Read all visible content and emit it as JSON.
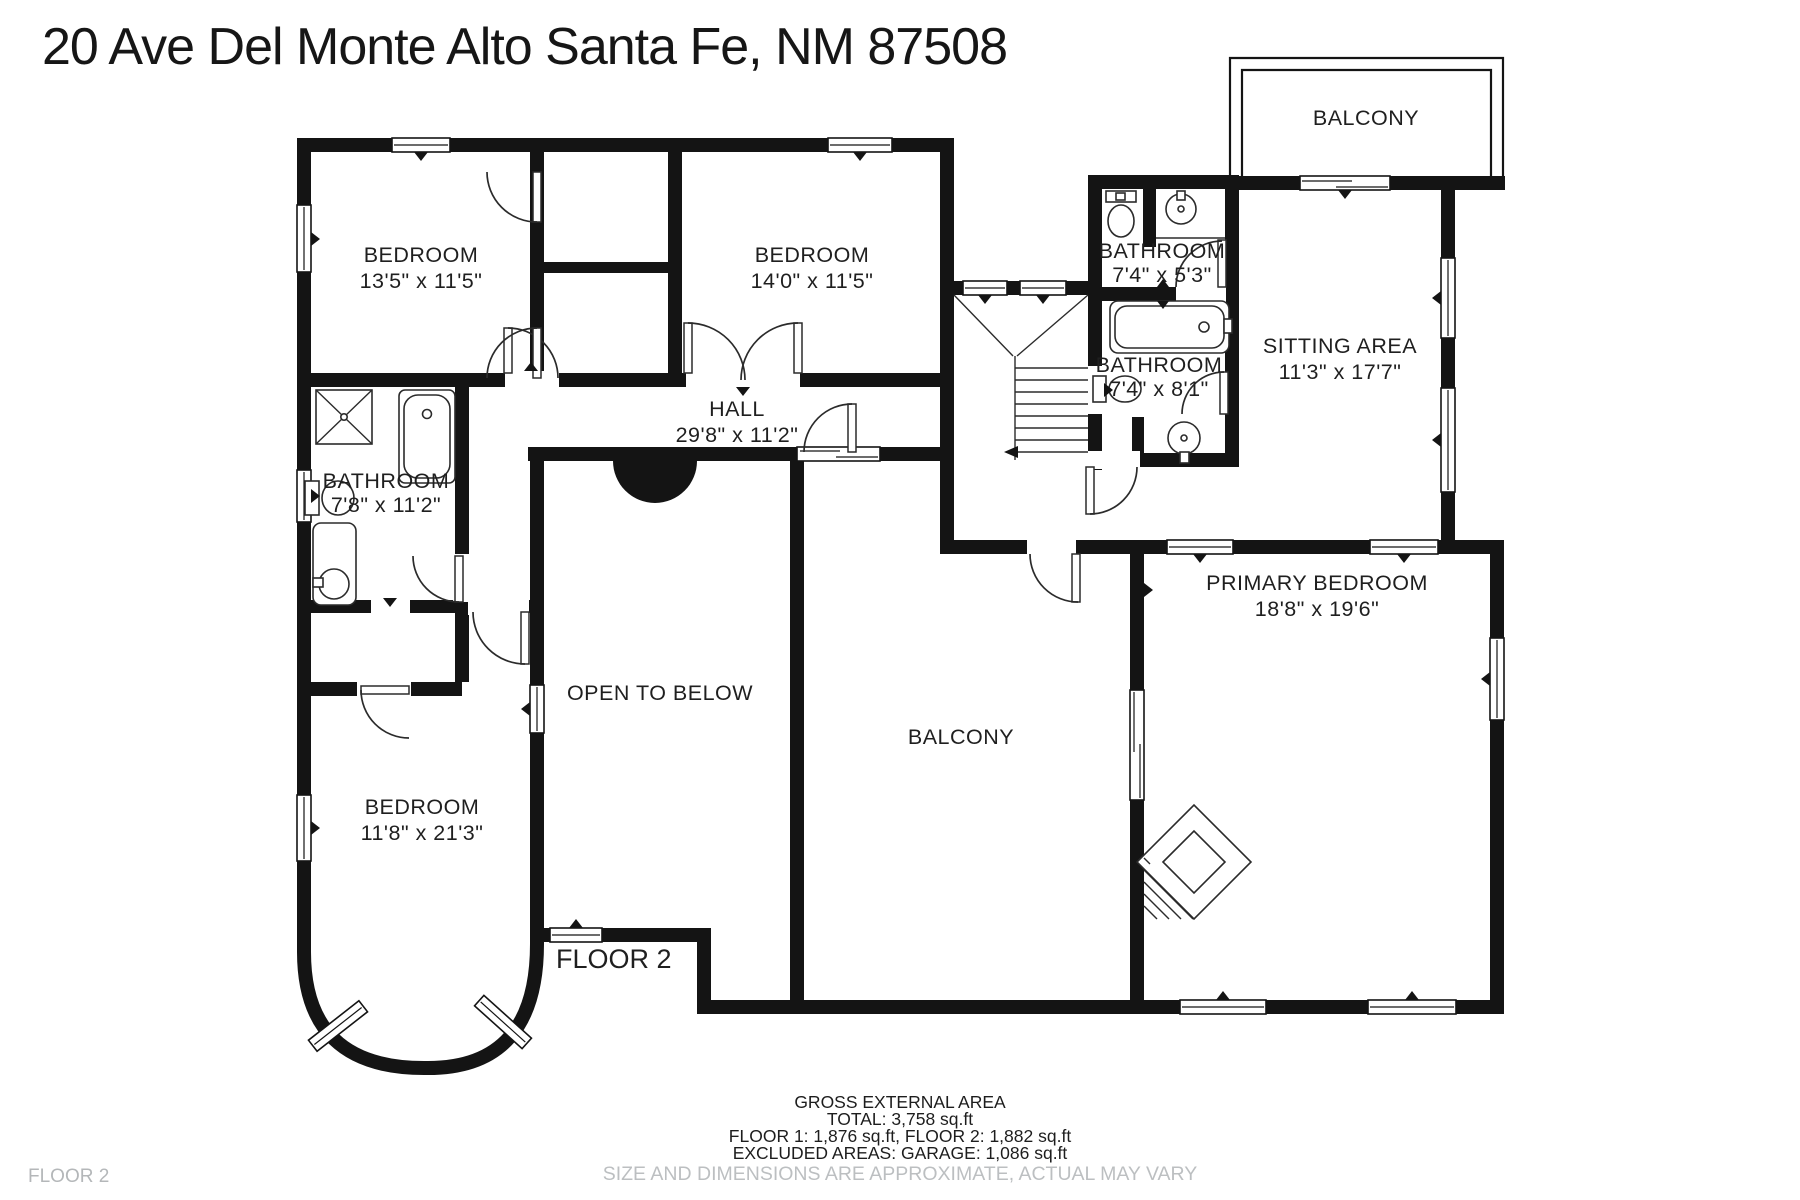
{
  "title": "20 Ave Del Monte Alto Santa Fe, NM 87508",
  "plan_floor_label": "FLOOR 2",
  "corner_floor_label": "FLOOR 2",
  "rooms": {
    "bedroom_top_left": {
      "name": "BEDROOM",
      "dims": "13'5\" x 11'5\""
    },
    "bedroom_top_mid": {
      "name": "BEDROOM",
      "dims": "14'0\" x 11'5\""
    },
    "bathroom_top": {
      "name": "BATHROOM",
      "dims": "7'4\" x 5'3\""
    },
    "balcony_top": {
      "name": "BALCONY"
    },
    "sitting_area": {
      "name": "SITTING AREA",
      "dims": "11'3\" x 17'7\""
    },
    "bathroom_mid": {
      "name": "BATHROOM",
      "dims": "7'4\" x 8'1\""
    },
    "hall": {
      "name": "HALL",
      "dims": "29'8\" x 11'2\""
    },
    "bathroom_left": {
      "name": "BATHROOM",
      "dims": "7'8\" x 11'2\""
    },
    "open_to_below": {
      "name": "OPEN TO BELOW"
    },
    "balcony_mid": {
      "name": "BALCONY"
    },
    "bedroom_bottom_left": {
      "name": "BEDROOM",
      "dims": "11'8\" x 21'3\""
    },
    "primary_bedroom": {
      "name": "PRIMARY BEDROOM",
      "dims": "18'8\" x 19'6\""
    }
  },
  "footer": {
    "area_title": "GROSS EXTERNAL AREA",
    "total": "TOTAL: 3,758 sq.ft",
    "floors": "FLOOR 1: 1,876 sq.ft, FLOOR 2: 1,882 sq.ft",
    "excluded": "EXCLUDED AREAS: GARAGE: 1,086 sq.ft",
    "disclaimer": "SIZE AND DIMENSIONS ARE APPROXIMATE, ACTUAL MAY VARY"
  },
  "colors": {
    "wall": "#141414",
    "background": "#ffffff",
    "muted_text": "#bcbfc1",
    "label_text": "#1f1f1f"
  }
}
